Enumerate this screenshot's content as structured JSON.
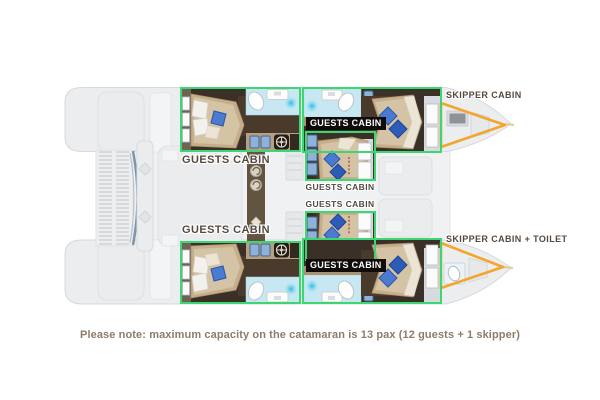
{
  "title": "Catamaran cabin layout floor plan",
  "note": {
    "text": "Please note: maximum capacity on the catamaran is 13 pax (12 guests + 1 skipper)"
  },
  "capacity": {
    "total_pax": 13,
    "guests": 12,
    "skipper": 1
  },
  "colors": {
    "cabin_highlight_green": "#3cd673",
    "skipper_highlight_orange": "#f3a52c",
    "halo_label_text": "#55493f",
    "tag_label_bg": "#0f0c0a",
    "tag_label_text": "#ffffff",
    "note_text": "#8d7c6c",
    "floor_dark_brown": "#3a3027",
    "bed_tan": "#c6ae8a",
    "pillow_blue": "#4a7bd0",
    "bathroom_blue": "#c7e8f3",
    "hull_gray": "#ebedef"
  },
  "labels": [
    {
      "id": "skipper-cabin-top",
      "text": "SKIPPER CABIN",
      "type": "halo",
      "left": 446,
      "top": 91,
      "size": 9,
      "width": 0
    },
    {
      "id": "guests-cabin-top-fwd",
      "text": "GUESTS CABIN",
      "type": "tag",
      "left": 306,
      "top": 117,
      "size": 9,
      "width": 0
    },
    {
      "id": "guests-cabin-top-aft",
      "text": "GUESTS CABIN",
      "type": "halo",
      "left": 176,
      "top": 155,
      "size": 11,
      "width": 100
    },
    {
      "id": "guests-cabin-mid-top",
      "text": "GUESTS CABIN",
      "type": "halo",
      "left": 303,
      "top": 183,
      "size": 8.5,
      "width": 74
    },
    {
      "id": "guests-cabin-mid-bot",
      "text": "GUESTS CABIN",
      "type": "halo",
      "left": 303,
      "top": 200,
      "size": 8.5,
      "width": 74
    },
    {
      "id": "guests-cabin-bot-aft",
      "text": "GUESTS CABIN",
      "type": "halo",
      "left": 176,
      "top": 225,
      "size": 11,
      "width": 100
    },
    {
      "id": "skipper-cabin-bottom",
      "text": "SKIPPER CABIN + TOILET",
      "type": "halo",
      "left": 446,
      "top": 235,
      "size": 9,
      "width": 0
    },
    {
      "id": "guests-cabin-bot-fwd",
      "text": "GUESTS CABIN",
      "type": "tag",
      "left": 306,
      "top": 259,
      "size": 9,
      "width": 0
    }
  ],
  "icons": [
    "helm-wheel-icon",
    "sink-icon",
    "faucet-icon",
    "toilet-icon",
    "shower-glow-icon",
    "bed-icon",
    "pillow-icon",
    "cabinet-icon",
    "drawer-icon",
    "window-icon",
    "door-icon",
    "stairs-icon",
    "hatch-icon",
    "trampoline-icon"
  ]
}
